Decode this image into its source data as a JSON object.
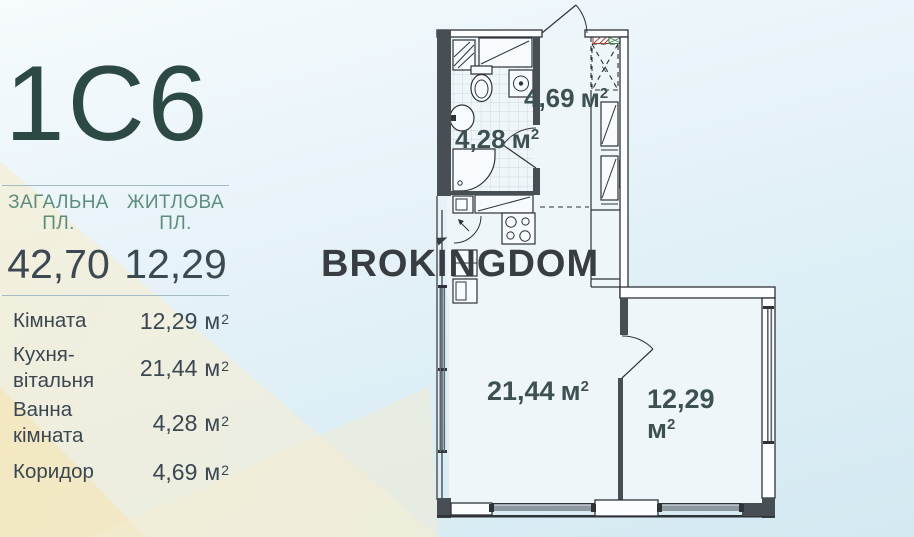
{
  "unit": {
    "label": "м",
    "sup": "2"
  },
  "panel": {
    "title": "1С6",
    "summary": [
      {
        "label_line1": "ЗАГАЛЬНА",
        "label_line2": "ПЛ.",
        "value": "42,70"
      },
      {
        "label_line1": "ЖИТЛОВА",
        "label_line2": "ПЛ.",
        "value": "12,29"
      }
    ],
    "rooms": [
      {
        "label": "Кімната",
        "label2": "",
        "value": "12,29"
      },
      {
        "label": "Кухня-",
        "label2": "вітальня",
        "value": "21,44"
      },
      {
        "label": "Ванна",
        "label2": "кімната",
        "value": "4,28"
      },
      {
        "label": "Коридор",
        "label2": "",
        "value": "4,69"
      }
    ]
  },
  "watermark": {
    "part1": "BROK",
    "part2": "I",
    "part3": "NGDOM"
  },
  "plan": {
    "areas": {
      "corridor": "4,69",
      "bathroom": "4,28",
      "kitchen_living": "21,44",
      "room_line1": "12,29"
    },
    "wardrobe_mark": "x"
  },
  "colors": {
    "title": "#2c4a43",
    "summary_label": "#5d8d7c",
    "text_dark": "#3a4650",
    "plan_label": "#3d5153",
    "watermark": "#383d41",
    "marker_red": "#9c3f33",
    "marker_green": "#3f7f44"
  }
}
